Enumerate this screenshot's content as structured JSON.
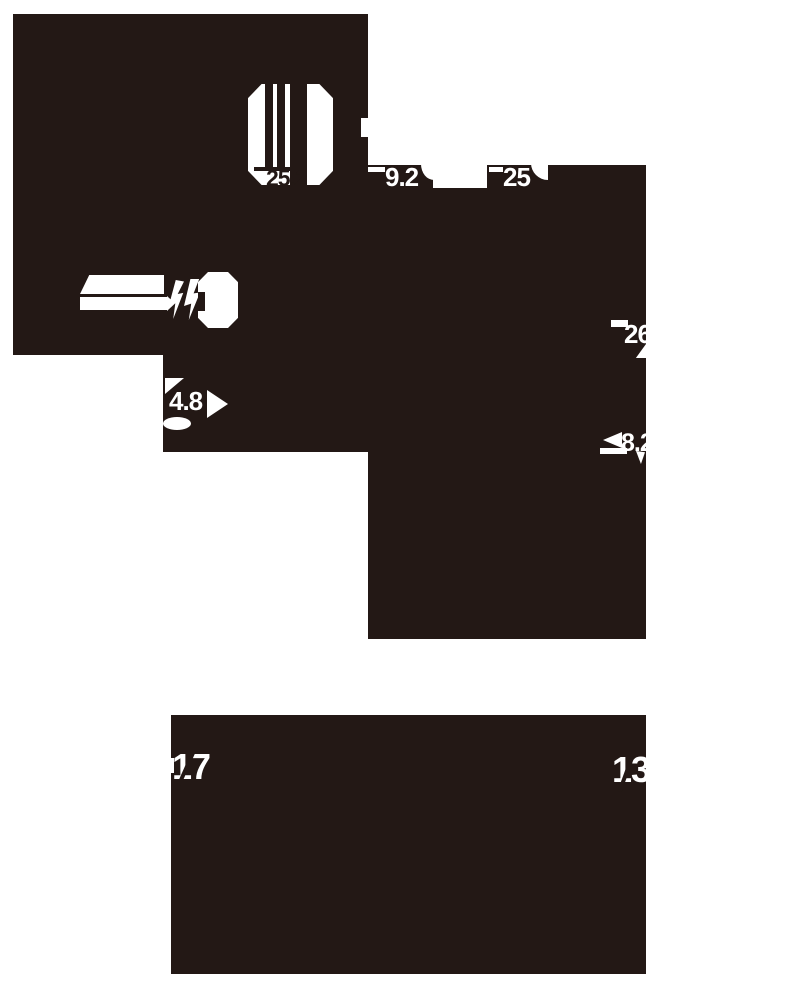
{
  "colors": {
    "ink": "#231815",
    "bg": "#ffffff"
  },
  "diagram": {
    "type": "product-dimension-drawing",
    "views": [
      "main-angled-silhouette",
      "front-silhouette"
    ],
    "units_shown": false,
    "labels": {
      "striped_part_width": "25.2",
      "band_left_width": "9.2",
      "band_right_width": "25",
      "right_edge_upper": "26",
      "right_edge_lower": "8.2",
      "left_step_depth": "4.8",
      "bottom_left": "17",
      "bottom_right": "13"
    }
  }
}
